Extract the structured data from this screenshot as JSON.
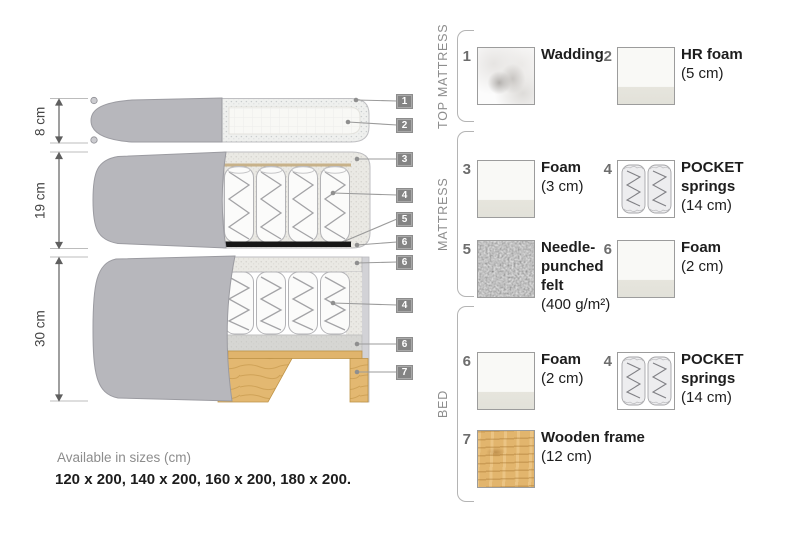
{
  "diagram": {
    "dimensions": [
      {
        "label": "8 cm"
      },
      {
        "label": "19 cm"
      },
      {
        "label": "30 cm"
      }
    ],
    "callouts": [
      {
        "number": "1",
        "points_to": "wadding"
      },
      {
        "number": "2",
        "points_to": "hr-foam"
      },
      {
        "number": "3",
        "points_to": "foam-3cm"
      },
      {
        "number": "4",
        "points_to": "pocket-springs"
      },
      {
        "number": "5",
        "points_to": "needle-punched-felt"
      },
      {
        "number": "6",
        "points_to": "foam-2cm"
      },
      {
        "number": "6",
        "points_to": "foam-2cm"
      },
      {
        "number": "4",
        "points_to": "pocket-springs"
      },
      {
        "number": "6",
        "points_to": "foam-2cm"
      },
      {
        "number": "7",
        "points_to": "wooden-frame"
      }
    ]
  },
  "legend": {
    "sections": [
      {
        "title": "TOP MATTRESS",
        "items": [
          {
            "number": "1",
            "name": "Wadding",
            "size": "",
            "swatch": "wadding"
          },
          {
            "number": "2",
            "name": "HR foam",
            "size": "(5 cm)",
            "swatch": "foam"
          }
        ]
      },
      {
        "title": "MATTRESS",
        "items": [
          {
            "number": "3",
            "name": "Foam",
            "size": "(3 cm)",
            "swatch": "foam"
          },
          {
            "number": "4",
            "name": "POCKET springs",
            "size": "(14 cm)",
            "swatch": "springs"
          },
          {
            "number": "5",
            "name": "Needle-punched felt",
            "size": "(400 g/m²)",
            "swatch": "felt"
          },
          {
            "number": "6",
            "name": "Foam",
            "size": "(2 cm)",
            "swatch": "foam"
          }
        ]
      },
      {
        "title": "BED",
        "items": [
          {
            "number": "6",
            "name": "Foam",
            "size": "(2 cm)",
            "swatch": "foam"
          },
          {
            "number": "4",
            "name": "POCKET springs",
            "size": "(14 cm)",
            "swatch": "springs"
          },
          {
            "number": "7",
            "name": "Wooden frame",
            "size": "(12 cm)",
            "swatch": "wood"
          }
        ]
      }
    ]
  },
  "footer": {
    "sizes_title": "Available in sizes (cm)",
    "sizes_list": "120 x 200, 140 x 200, 160 x 200, 180 x 200."
  },
  "colors": {
    "cover_gray": "#b7b7bc",
    "foam_speckle": "#eae9e4",
    "felt_black_strip": "#171717",
    "wood": "#e2b56d",
    "callout_box": "#848484",
    "leader_line": "#9b9b9b",
    "label_text": "#1d1d1d",
    "muted_text": "#8d8d8d"
  }
}
